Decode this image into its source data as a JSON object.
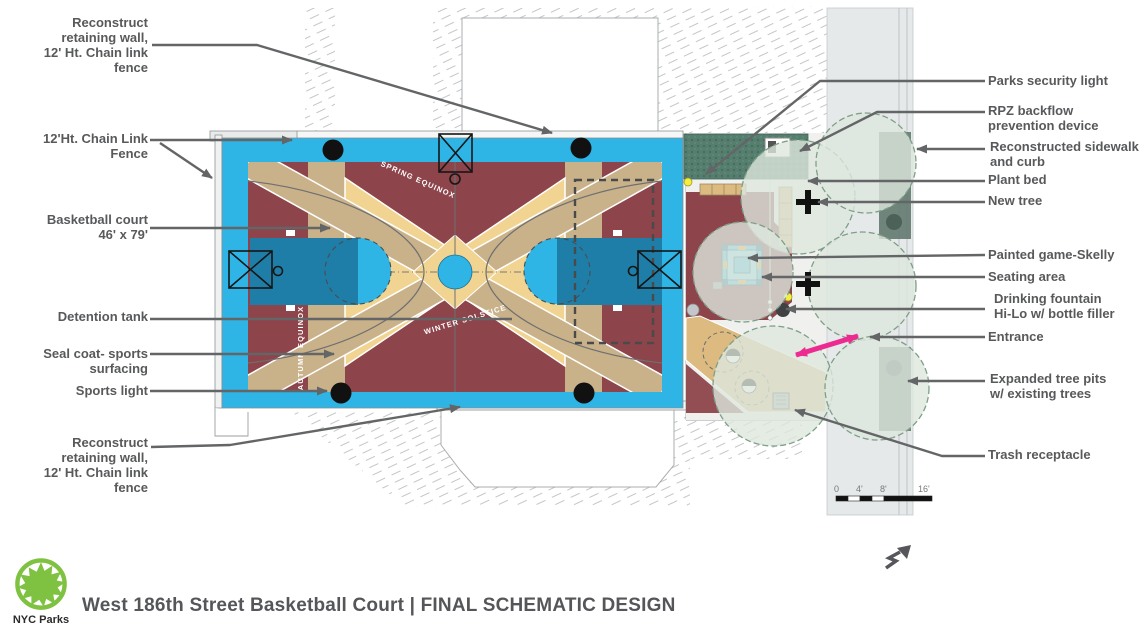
{
  "branding": {
    "logo_text": "NYC Parks",
    "title": "West 186th Street Basketball Court  |  FINAL SCHEMATIC DESIGN"
  },
  "callouts_left": [
    {
      "text": "Reconstruct\nretaining wall,\n12' Ht. Chain link\nfence"
    },
    {
      "text": "12'Ht. Chain Link\nFence"
    },
    {
      "text": "Basketball court\n46' x 79'"
    },
    {
      "text": "Detention tank"
    },
    {
      "text": "Seal coat- sports\nsurfacing"
    },
    {
      "text": "Sports light"
    },
    {
      "text": "Reconstruct\nretaining wall,\n12' Ht. Chain link\nfence"
    }
  ],
  "callouts_right": [
    {
      "text": "Parks security light"
    },
    {
      "text": "RPZ backflow\nprevention device"
    },
    {
      "text": "Reconstructed sidewalk\nand curb"
    },
    {
      "text": "Plant bed"
    },
    {
      "text": "New tree"
    },
    {
      "text": "Painted game-Skelly"
    },
    {
      "text": "Seating area"
    },
    {
      "text": "Drinking fountain\nHi-Lo w/ bottle filler"
    },
    {
      "text": "Entrance"
    },
    {
      "text": "Expanded tree pits\nw/ existing trees"
    },
    {
      "text": "Trash receptacle"
    }
  ],
  "plan_texts": {
    "spring": "SPRING EQUINOX",
    "winter": "WINTER SOLSTICE",
    "autumn": "AUTUMN EQUINOX"
  },
  "scale_bar": {
    "ticks": [
      "0",
      "4'",
      "8'",
      "16'"
    ]
  },
  "colors": {
    "seal_coat_cyan": "#2eb5e6",
    "court_maroon": "#8d444b",
    "key_blue": "#1e7ea8",
    "tan_light": "#f2d492",
    "tan_dark": "#c9b189",
    "path_tan": "#dcba80",
    "plant_bed_green": "#567e6f",
    "tree_canopy_green": "#dde7dd",
    "entrance_magenta": "#ec2a90",
    "callout_gray": "#58595b",
    "logo_green": "#7fc242"
  }
}
